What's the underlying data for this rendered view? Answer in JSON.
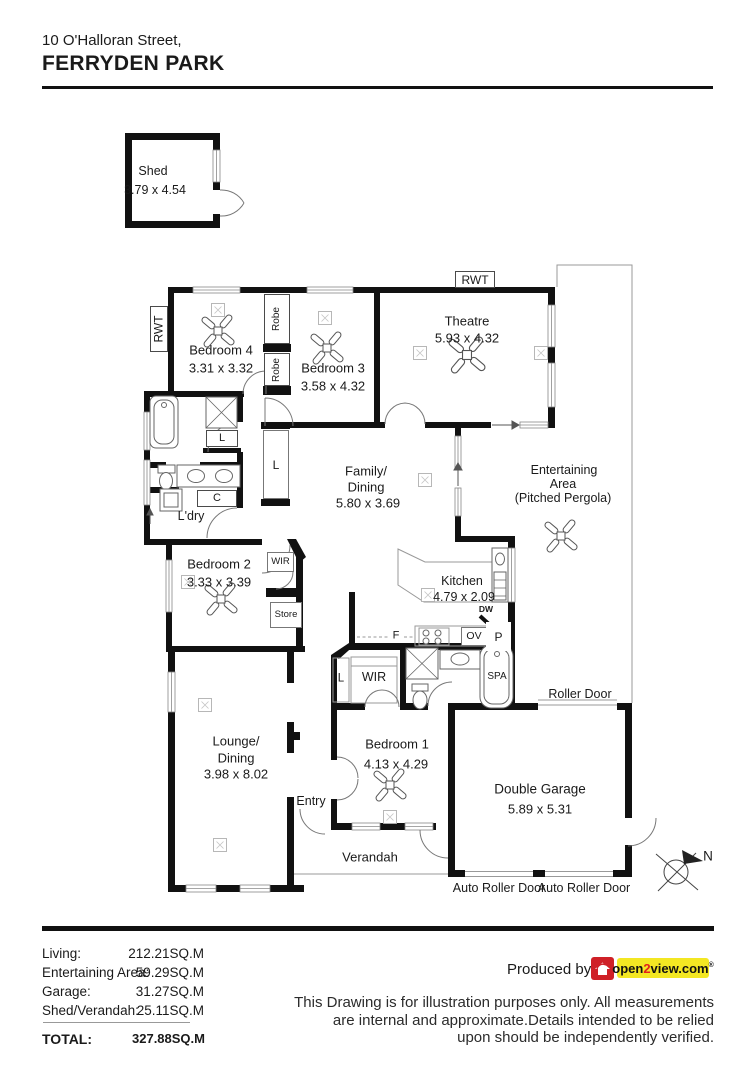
{
  "header": {
    "address": "10 O'Halloran Street,",
    "suburb": "FERRYDEN PARK"
  },
  "rooms": {
    "shed": {
      "name": "Shed",
      "dims": "3.79 x 4.54"
    },
    "bedroom4": {
      "name": "Bedroom 4",
      "dims": "3.31 x 3.32"
    },
    "bedroom3": {
      "name": "Bedroom 3",
      "dims": "3.58 x 4.32"
    },
    "theatre": {
      "name": "Theatre",
      "dims": "5.93 x 4.32"
    },
    "family": {
      "line1": "Family/",
      "line2": "Dining",
      "dims": "5.80 x 3.69"
    },
    "entertaining": {
      "line1": "Entertaining",
      "line2": "Area",
      "line3": "(Pitched Pergola)"
    },
    "bedroom2": {
      "name": "Bedroom 2",
      "dims": "3.33 x 3.39"
    },
    "kitchen": {
      "name": "Kitchen",
      "dims": "4.79 x 2.09"
    },
    "laundry": {
      "name": "L'dry"
    },
    "lounge": {
      "line1": "Lounge/",
      "line2": "Dining",
      "dims": "3.98 x 8.02"
    },
    "bedroom1": {
      "name": "Bedroom 1",
      "dims": "4.13 x 4.29"
    },
    "garage": {
      "name": "Double Garage",
      "dims": "5.89 x 5.31"
    },
    "entry": {
      "name": "Entry"
    },
    "verandah": {
      "name": "Verandah"
    }
  },
  "labels": {
    "rwt_top": "RWT",
    "rwt_left": "RWT",
    "robe_top": "Robe",
    "robe_bottom": "Robe",
    "linen_bath": "L",
    "linen_hall": "L",
    "cupboard": "C",
    "wir_bed2": "WIR",
    "store": "Store",
    "fridge": "F",
    "oven": "OV",
    "pantry": "P",
    "dishwasher": "DW",
    "spa": "SPA",
    "linen_bed1": "L",
    "wir_bed1": "WIR",
    "roller_door": "Roller Door",
    "auto_roller_door_left": "Auto Roller Door",
    "auto_roller_door_right": "Auto Roller Door",
    "north": "N"
  },
  "summary": {
    "rows": [
      {
        "label": "Living:",
        "value": "212.21SQ.M"
      },
      {
        "label": "Entertaining Area:",
        "value": "59.29SQ.M"
      },
      {
        "label": "Garage:",
        "value": "31.27SQ.M"
      },
      {
        "label": "Shed/Verandah:",
        "value": "25.11SQ.M"
      }
    ],
    "total_label": "TOTAL:",
    "total_value": "327.88SQ.M"
  },
  "branding": {
    "produced_by": "Produced by",
    "logo_open": "open",
    "logo_2": "2",
    "logo_view": "view.com",
    "logo_reg": "®"
  },
  "disclaimer": {
    "line1": "This Drawing is for illustration purposes only. All measurements",
    "line2": "are internal and approximate.Details intended to be relied",
    "line3": "upon should be  independently verified."
  },
  "colors": {
    "wall": "#111111",
    "logo_red": "#cf2027",
    "logo_yellow": "#f3e723"
  }
}
